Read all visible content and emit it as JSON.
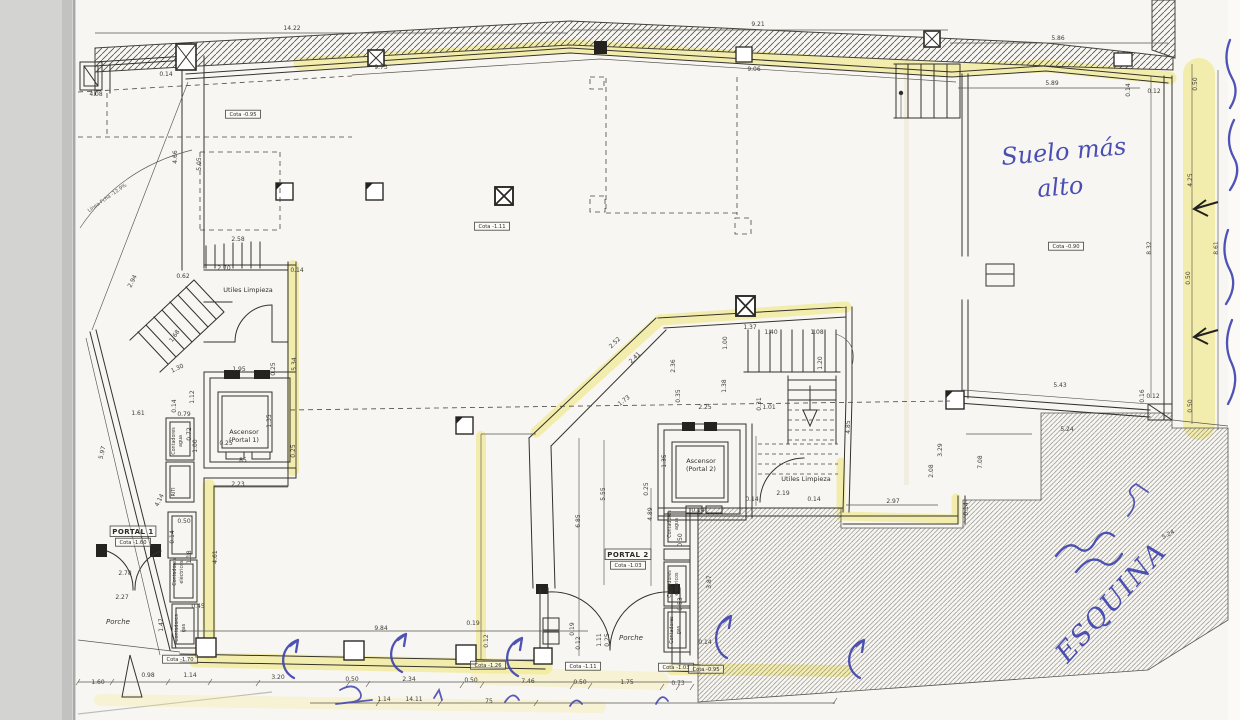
{
  "document": {
    "kind": "scanned architectural floor plan",
    "colors": {
      "highlighter": "#f0e468",
      "pen_ink": "#3c40ae",
      "paper": "#f7f6f2",
      "scanner_bed": "#d3d3d1"
    }
  },
  "hand": {
    "note_line1": "Suelo más",
    "note_line2": "alto",
    "esquina": "ESQUINA"
  },
  "plan": {
    "boxed": [
      [
        "PORTAL 1",
        133,
        534,
        1
      ],
      [
        "Cota -1.60",
        133,
        544,
        0
      ],
      [
        "PORTAL 2",
        628,
        557,
        1
      ],
      [
        "Cota -1.03",
        628,
        567,
        0
      ],
      [
        "Cota -0.95",
        243,
        116,
        0
      ],
      [
        "Cota -1.11",
        492,
        228,
        0
      ],
      [
        "Cota -0.90",
        1066,
        248,
        0
      ],
      [
        "Cota -1.70",
        180,
        661,
        0
      ],
      [
        "Cota -1.26",
        488,
        667,
        0
      ],
      [
        "Cota -1.11",
        583,
        668,
        0
      ],
      [
        "Cota -1.03",
        676,
        669,
        0
      ],
      [
        "Cota -0.95",
        706,
        671,
        0
      ]
    ],
    "texts": [
      [
        "Utiles Limpieza",
        248,
        292,
        0,
        "room"
      ],
      [
        "Ascensor",
        244,
        434,
        0,
        "room"
      ],
      [
        "(Portal 1)",
        244,
        442,
        0,
        "room"
      ],
      [
        "Ascensor",
        701,
        463,
        0,
        "room"
      ],
      [
        "(Portal 2)",
        701,
        471,
        0,
        "room"
      ],
      [
        "Utiles Limpieza",
        806,
        481,
        0,
        "room"
      ],
      [
        "Porche",
        118,
        624,
        0,
        "room-i"
      ],
      [
        "Porche",
        631,
        640,
        0,
        "room-i"
      ],
      [
        "Contadores",
        175,
        441,
        -90,
        "vert"
      ],
      [
        "agua",
        182,
        441,
        -90,
        "vert"
      ],
      [
        "RITI",
        175,
        492,
        -90,
        "vert"
      ],
      [
        "Contadores",
        176,
        572,
        -90,
        "vert"
      ],
      [
        "eléctricos",
        183,
        572,
        -90,
        "vert"
      ],
      [
        "Contadores",
        178,
        628,
        -90,
        "vert"
      ],
      [
        "gas",
        185,
        628,
        -90,
        "vert"
      ],
      [
        "Contadores",
        671,
        524,
        -90,
        "vert"
      ],
      [
        "agua",
        678,
        524,
        -90,
        "vert"
      ],
      [
        "Contadores",
        671,
        584,
        -90,
        "vert"
      ],
      [
        "eléctricos",
        678,
        584,
        -90,
        "vert"
      ],
      [
        "Contadores",
        673,
        630,
        -90,
        "vert"
      ],
      [
        "gas",
        680,
        630,
        -90,
        "vert"
      ],
      [
        "Línea Fcha -12.9%",
        108,
        199,
        -35,
        "tiny"
      ]
    ],
    "dimensions": [
      [
        "14.22",
        292,
        30,
        0
      ],
      [
        "9.21",
        758,
        26,
        0
      ],
      [
        "5.86",
        1058,
        40,
        0
      ],
      [
        "0.14",
        166,
        76,
        0
      ],
      [
        "4.08",
        96,
        96,
        0
      ],
      [
        "9.73",
        381,
        69,
        0
      ],
      [
        "9.06",
        754,
        71,
        0
      ],
      [
        "5.89",
        1052,
        85,
        0
      ],
      [
        "0.50",
        1197,
        84,
        -90
      ],
      [
        "0.14",
        1130,
        90,
        -90
      ],
      [
        "0.12",
        1154,
        93,
        0
      ],
      [
        "4.25",
        1192,
        180,
        -90
      ],
      [
        "8.32",
        1151,
        248,
        -90
      ],
      [
        "8.61",
        1218,
        248,
        -90
      ],
      [
        "0.50",
        1190,
        278,
        -90
      ],
      [
        "5.05",
        201,
        164,
        -90
      ],
      [
        "4.66",
        177,
        157,
        -90
      ],
      [
        "2.58",
        238,
        241,
        0
      ],
      [
        "2.70",
        224,
        270,
        0
      ],
      [
        "0.62",
        183,
        278,
        0
      ],
      [
        "0.14",
        297,
        272,
        0
      ],
      [
        "2.94",
        134,
        282,
        -63
      ],
      [
        "1.68",
        176,
        337,
        -55
      ],
      [
        "1.30",
        178,
        370,
        -25
      ],
      [
        "1.95",
        239,
        371,
        0
      ],
      [
        "0.25",
        275,
        369,
        -90
      ],
      [
        "5.34",
        296,
        364,
        -90
      ],
      [
        "1.12",
        194,
        397,
        -90
      ],
      [
        "0.14",
        176,
        406,
        -90
      ],
      [
        "1.61",
        138,
        415,
        0
      ],
      [
        "0.79",
        184,
        416,
        0
      ],
      [
        "0.72",
        191,
        434,
        -90
      ],
      [
        "1.00",
        197,
        446,
        -90
      ],
      [
        "0.25",
        226,
        445,
        0
      ],
      [
        "1.35",
        271,
        421,
        -90
      ],
      [
        "85",
        243,
        462,
        0
      ],
      [
        "0.25",
        295,
        451,
        -90
      ],
      [
        "2.23",
        238,
        486,
        0
      ],
      [
        "4.14",
        161,
        501,
        -63
      ],
      [
        "5.97",
        104,
        453,
        -77
      ],
      [
        "0.50",
        184,
        523,
        0
      ],
      [
        "0.14",
        174,
        537,
        -90
      ],
      [
        "1.18",
        191,
        557,
        -90
      ],
      [
        "4.61",
        217,
        557,
        -90
      ],
      [
        "2.78",
        125,
        575,
        0
      ],
      [
        "2.27",
        122,
        599,
        0
      ],
      [
        "0.45",
        198,
        608,
        0
      ],
      [
        "1.47",
        163,
        625,
        -90
      ],
      [
        "9.84",
        381,
        630,
        0
      ],
      [
        "1.60",
        98,
        684,
        0
      ],
      [
        "0.98",
        148,
        677,
        0
      ],
      [
        "1.14",
        190,
        677,
        0
      ],
      [
        "3.20",
        278,
        679,
        0
      ],
      [
        "0.50",
        352,
        681,
        0
      ],
      [
        "2.34",
        409,
        681,
        0
      ],
      [
        "0.50",
        471,
        682,
        0
      ],
      [
        "7.46",
        528,
        683,
        0
      ],
      [
        "0.50",
        580,
        684,
        0
      ],
      [
        "1.75",
        627,
        684,
        0
      ],
      [
        "0.73",
        678,
        685,
        0
      ],
      [
        "1.14",
        384,
        701,
        0
      ],
      [
        "14.11",
        414,
        701,
        0
      ],
      [
        "75",
        489,
        703,
        0
      ],
      [
        "2.52",
        616,
        344,
        -44
      ],
      [
        "2.41",
        636,
        359,
        -44
      ],
      [
        "1.73",
        625,
        402,
        -38
      ],
      [
        "2.36",
        675,
        366,
        -90
      ],
      [
        "0.35",
        680,
        396,
        -90
      ],
      [
        "2.25",
        705,
        409,
        0
      ],
      [
        "1.37",
        750,
        329,
        0
      ],
      [
        "1.40",
        771,
        334,
        0
      ],
      [
        "1.08",
        817,
        334,
        0
      ],
      [
        "1.00",
        727,
        343,
        -90
      ],
      [
        "1.38",
        726,
        386,
        -90
      ],
      [
        "0.31",
        761,
        404,
        -90
      ],
      [
        "1.01",
        769,
        409,
        0
      ],
      [
        "1.20",
        822,
        363,
        -90
      ],
      [
        "1.35",
        666,
        461,
        -90
      ],
      [
        "0.25",
        648,
        489,
        -90
      ],
      [
        "4.89",
        652,
        514,
        -90
      ],
      [
        "5.55",
        605,
        494,
        -90
      ],
      [
        "6.85",
        580,
        521,
        -90
      ],
      [
        "0.14",
        698,
        512,
        0
      ],
      [
        "2.19",
        783,
        495,
        0
      ],
      [
        "0.14",
        752,
        501,
        0
      ],
      [
        "0.14",
        814,
        501,
        0
      ],
      [
        "0.50",
        682,
        540,
        -90
      ],
      [
        "0.53",
        682,
        604,
        -90
      ],
      [
        "3.87",
        711,
        582,
        -90
      ],
      [
        "0.14",
        705,
        644,
        0
      ],
      [
        "0.19",
        473,
        625,
        0
      ],
      [
        "0.12",
        488,
        641,
        -90
      ],
      [
        "0.19",
        574,
        629,
        -90
      ],
      [
        "0.12",
        580,
        643,
        -90
      ],
      [
        "1.11",
        601,
        640,
        -90
      ],
      [
        "0.25",
        609,
        640,
        -90
      ],
      [
        "4.85",
        850,
        427,
        -90
      ],
      [
        "3.29",
        942,
        450,
        -90
      ],
      [
        "7.08",
        982,
        462,
        -90
      ],
      [
        "2.08",
        933,
        471,
        -90
      ],
      [
        "2.97",
        893,
        503,
        0
      ],
      [
        "0.14",
        968,
        509,
        -90
      ],
      [
        "5.43",
        1060,
        387,
        0
      ],
      [
        "0.16",
        1144,
        396,
        -90
      ],
      [
        "0.12",
        1153,
        398,
        0
      ],
      [
        "0.50",
        1192,
        406,
        -90
      ],
      [
        "5.24",
        1067,
        431,
        0
      ],
      [
        "5.24",
        1169,
        536,
        -28
      ]
    ]
  }
}
